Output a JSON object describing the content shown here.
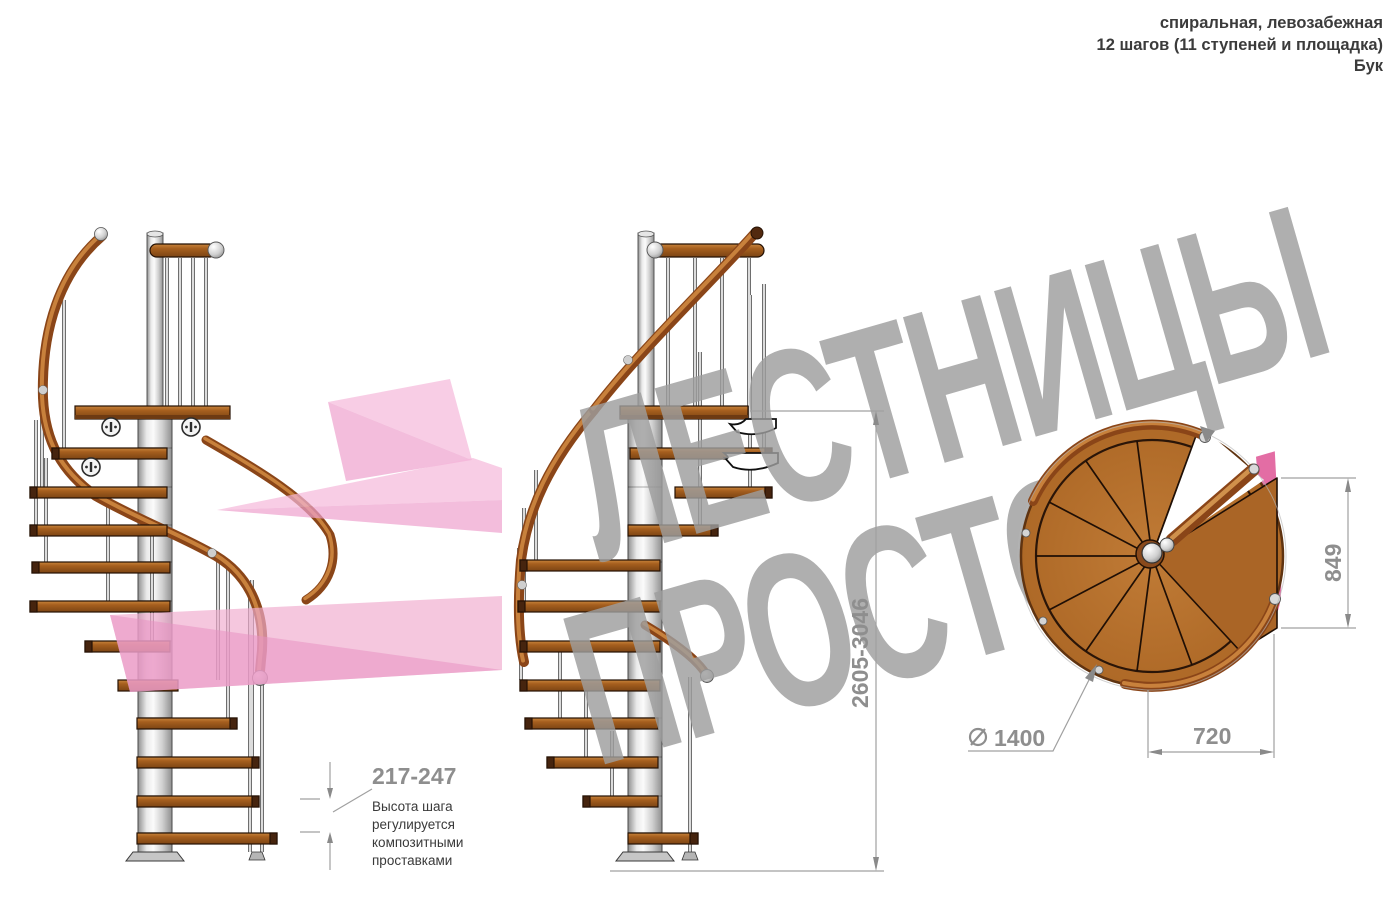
{
  "header": {
    "line1": "спиральная, левозабежная",
    "line2": "12 шагов (11 ступеней и площадка)",
    "line3": "Бук"
  },
  "watermark": {
    "line1": "ЛЕСТНИЦЫ",
    "line2_main": "ПРОСТО",
    "line2_accent": ".ру"
  },
  "dimensions": {
    "step_height": {
      "value": "217-247",
      "note": [
        "Высота шага",
        "регулируется",
        "композитными",
        "проставками"
      ]
    },
    "total_height": {
      "value": "2605-3046"
    },
    "landing_depth": {
      "value": "849"
    },
    "landing_width": {
      "value": "720"
    },
    "diameter": {
      "symbol": "diameter-sign",
      "value": "1400"
    }
  },
  "views": {
    "left": "side elevation of spiral staircase",
    "middle": "side elevation rotated with height dimension",
    "plan": "top plan view with 11 wedge steps and landing"
  },
  "colors": {
    "wood": "#a35c1c",
    "wood_rail": "#9c5120",
    "dimension_gray": "#8e8e8e",
    "watermark_gray": "#9e9e9e",
    "watermark_pink": "#de5494",
    "arrow_pink": "#eea1cd",
    "metal": "#d8d8d8"
  }
}
